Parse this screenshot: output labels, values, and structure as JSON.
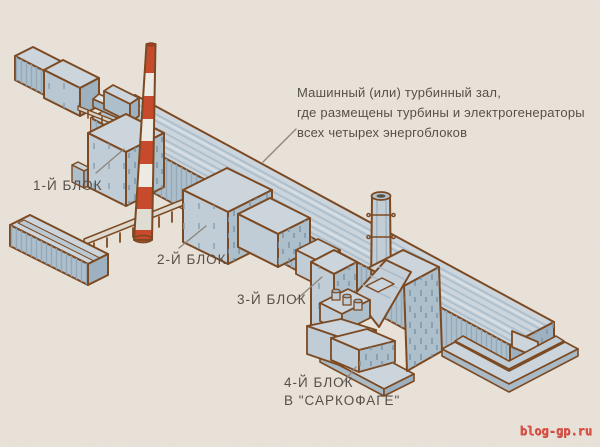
{
  "diagram": {
    "machine_hall_note": {
      "lines": [
        "Машинный (или) турбинный зал,",
        "где размещены турбины и электрогенераторы",
        "всех четырех энергоблоков"
      ]
    },
    "labels": {
      "block1": "1-Й БЛОК",
      "block2": "2-Й БЛОК",
      "block3": "3-Й БЛОК",
      "block4": [
        "4-Й БЛОК",
        "В \"САРКОФАГЕ\""
      ]
    },
    "watermark": "blog-gp.ru",
    "colors": {
      "background": "#e9e2d9",
      "outline_brown": "#7c4a22",
      "building_light": "#ccd5dc",
      "building_mid": "#aebfcc",
      "building_dark": "#9db1c1",
      "chimney_red": "#c64a2b",
      "chimney_white": "#edeae3",
      "text": "#57504a",
      "leader_line": "#8e867b",
      "watermark_red": "#dc5247"
    }
  }
}
